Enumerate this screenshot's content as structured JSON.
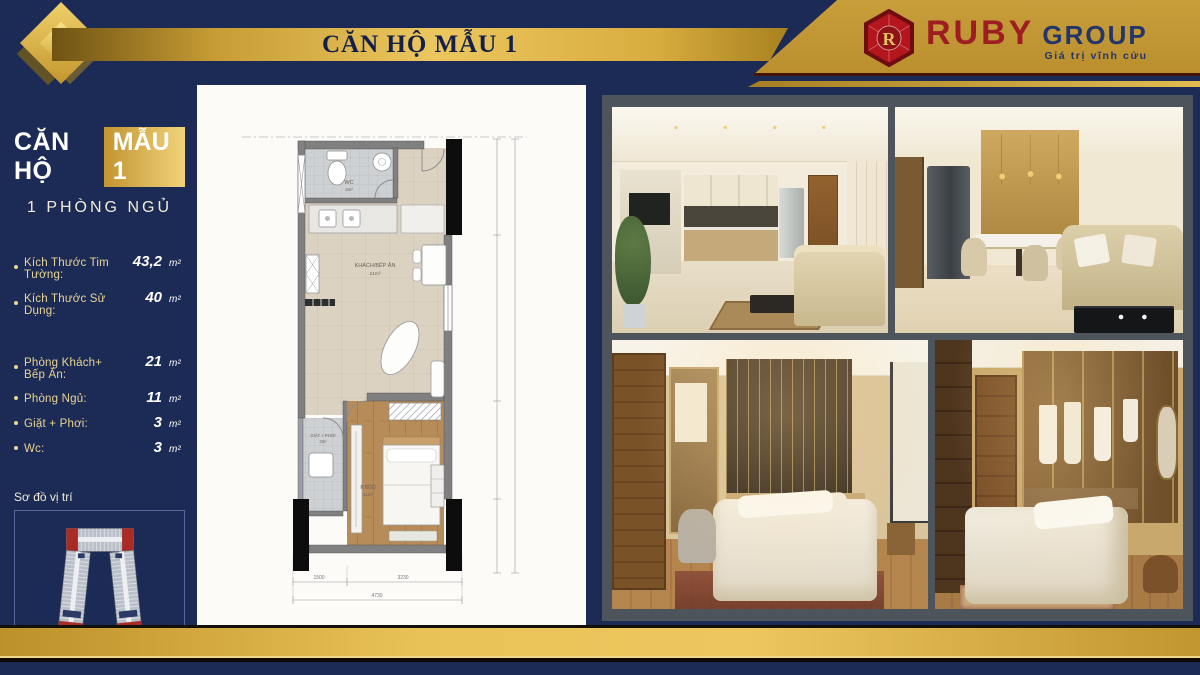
{
  "header": {
    "title": "CĂN HỘ MẪU 1",
    "brand": {
      "monogram": "R",
      "name": "RUBY",
      "suffix": "GROUP",
      "tagline": "Giá trị vĩnh cửu"
    }
  },
  "sidebar": {
    "title_prefix": "CĂN HỘ",
    "title_highlight": "MẪU 1",
    "subtitle": "1 PHÒNG NGỦ",
    "specs_primary": [
      {
        "label": "Kích Thước Tim Tường:",
        "value": "43,2",
        "unit": "m²"
      },
      {
        "label": "Kích Thước Sử Dụng:",
        "value": "40",
        "unit": "m²"
      }
    ],
    "specs_rooms": [
      {
        "label": "Phòng Khách+ Bếp Ăn:",
        "value": "21",
        "unit": "m²"
      },
      {
        "label": "Phòng Ngủ:",
        "value": "11",
        "unit": "m²"
      },
      {
        "label": "Giặt + Phơi:",
        "value": "3",
        "unit": "m²"
      },
      {
        "label": "Wc:",
        "value": "3",
        "unit": "m²"
      }
    ],
    "location_label": "Sơ đồ vị trí"
  },
  "floor_plan": {
    "wc": {
      "name": "WC",
      "area": "3m²"
    },
    "living": {
      "name": "KHÁCH/BẾP ĂN",
      "area": "21m²"
    },
    "laundry": {
      "name": "GIẶT + PHƠI",
      "area": "3m²"
    },
    "bedroom": {
      "name": "P.NGỦ",
      "area": "11m²"
    },
    "dimensions": {
      "left": "1500",
      "right": "3230",
      "total": "4730"
    }
  },
  "colors": {
    "navy": "#1c2b55",
    "gold": "#d2a43c",
    "ruby": "#9e1b22",
    "cream": "#e8d494"
  }
}
